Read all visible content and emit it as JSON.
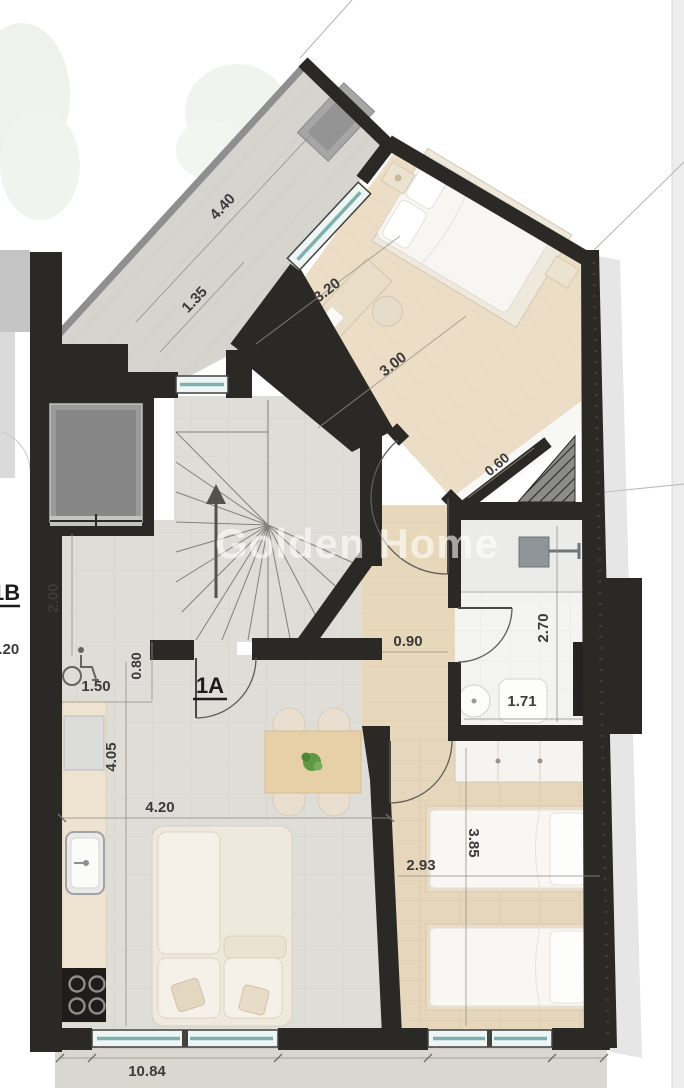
{
  "plan": {
    "watermark": "Golden Home",
    "unit_label": "1A",
    "neighbor_unit_label": "1B",
    "dimensions": {
      "terrace_length": "4.40",
      "terrace_width": "1.35",
      "bedroom1_window_wall": "3.20",
      "bedroom1_width": "3.00",
      "shaft_strip": "0.60",
      "hall_length": "2.00",
      "hall_opening": "0.80",
      "entry_width": "1.50",
      "corridor_width": "0.90",
      "bathroom_length": "2.70",
      "bathroom_width": "1.71",
      "living_height": "4.05",
      "living_width": "4.20",
      "bedroom2_width": "2.93",
      "bedroom2_length": "3.85",
      "neighbor_dim": "1.20",
      "total_width": "10.84"
    },
    "colors": {
      "wall": "#2b2925",
      "glass": "#cde8e7",
      "wood_floor": "#ecdec6",
      "concrete_floor": "#dfddd7",
      "plant": "#5f9a43"
    }
  }
}
